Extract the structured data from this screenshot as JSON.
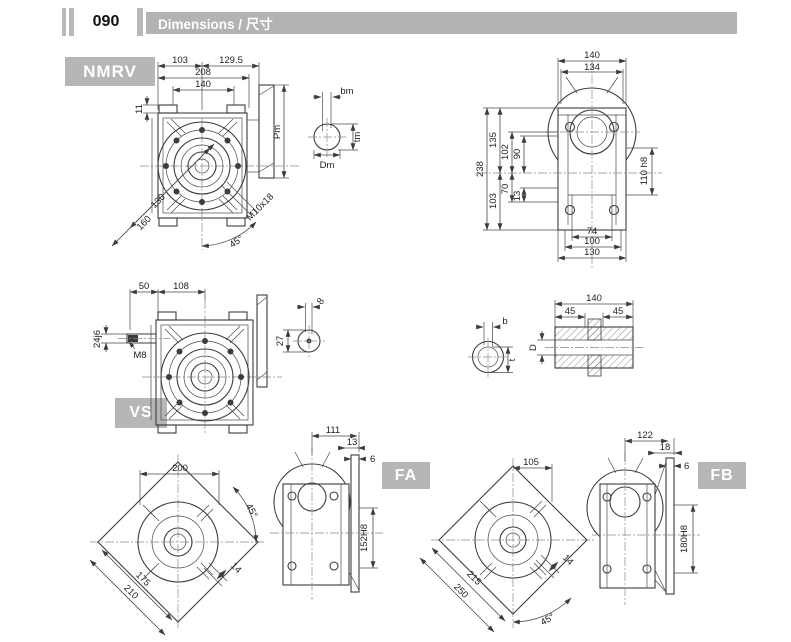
{
  "header": {
    "page_number": "090",
    "title": "Dimensions / 尺寸"
  },
  "badges": {
    "nmrv": "NMRV",
    "vs": "VS",
    "fa": "FA",
    "fb": "FB"
  },
  "colors": {
    "header_bar": "#b3b3b3",
    "badge_bg": "#b6b6b6",
    "badge_text": "#ffffff",
    "line": "#3c3c3c"
  },
  "nmrv_front": {
    "w_left": "103",
    "w_right": "129.5",
    "w_total": "208",
    "w_bolts": "140",
    "pad_h": "11",
    "flange_h": "Pm",
    "diag_inner": "130",
    "diag_outer": "160",
    "stud": "M10x18",
    "angle": "45°"
  },
  "output_shaft": {
    "key_w": "bm",
    "key_t": "tm",
    "dia": "Dm"
  },
  "nmrv_side": {
    "w1": "140",
    "w2": "134",
    "h_total": "238",
    "h_upper": "135",
    "h_lower": "103",
    "h1": "102",
    "h2": "90",
    "h3": "70",
    "h4": "13",
    "bore": "110 h8",
    "b1": "74",
    "b2": "100",
    "b3": "130"
  },
  "vs_front": {
    "shaft_len": "50",
    "to_center": "108",
    "shaft_dia": "24j6",
    "thread": "M8"
  },
  "vs_shaft": {
    "key_w": "8",
    "key_t": "27"
  },
  "bore_section": {
    "key_w": "b",
    "key_t": "t"
  },
  "hollow_shaft": {
    "len": "140",
    "w_left": "45",
    "w_right": "45",
    "dia": "D"
  },
  "fa": {
    "front_w": "200",
    "angle": "45°",
    "diag_inner": "175",
    "diag_outer": "210",
    "key": "14",
    "depth": "111",
    "d2": "13",
    "d3": "6",
    "pilot": "152H8"
  },
  "fb": {
    "front_w": "105",
    "angle": "45°",
    "diag_inner": "215",
    "diag_outer": "250",
    "key": "14",
    "depth": "122",
    "d2": "18",
    "d3": "6",
    "pilot": "180H8"
  }
}
